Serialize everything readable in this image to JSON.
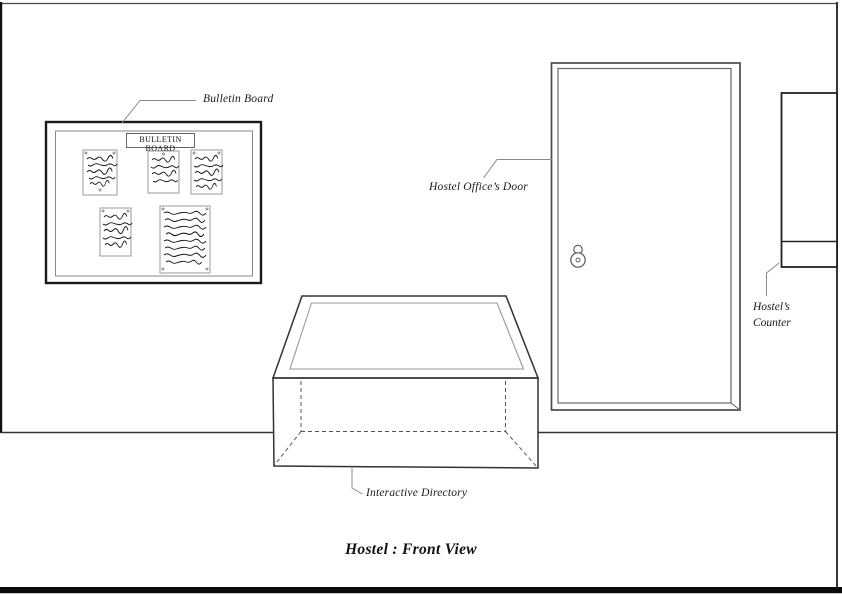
{
  "page": {
    "title": "Hostel : Front View"
  },
  "annotations": {
    "bulletin_board": "Bulletin Board",
    "office_door": "Hostel Office’s Door",
    "counter_line1": "Hostel’s",
    "counter_line2": "Counter",
    "directory": "Interactive Directory"
  },
  "bulletin_board": {
    "header": "BULLETIN BOARD",
    "notes_count": 5
  },
  "colors": {
    "ink": "#1a1a1a",
    "frame": "#000000",
    "light_line": "#888888",
    "background": "#ffffff"
  }
}
